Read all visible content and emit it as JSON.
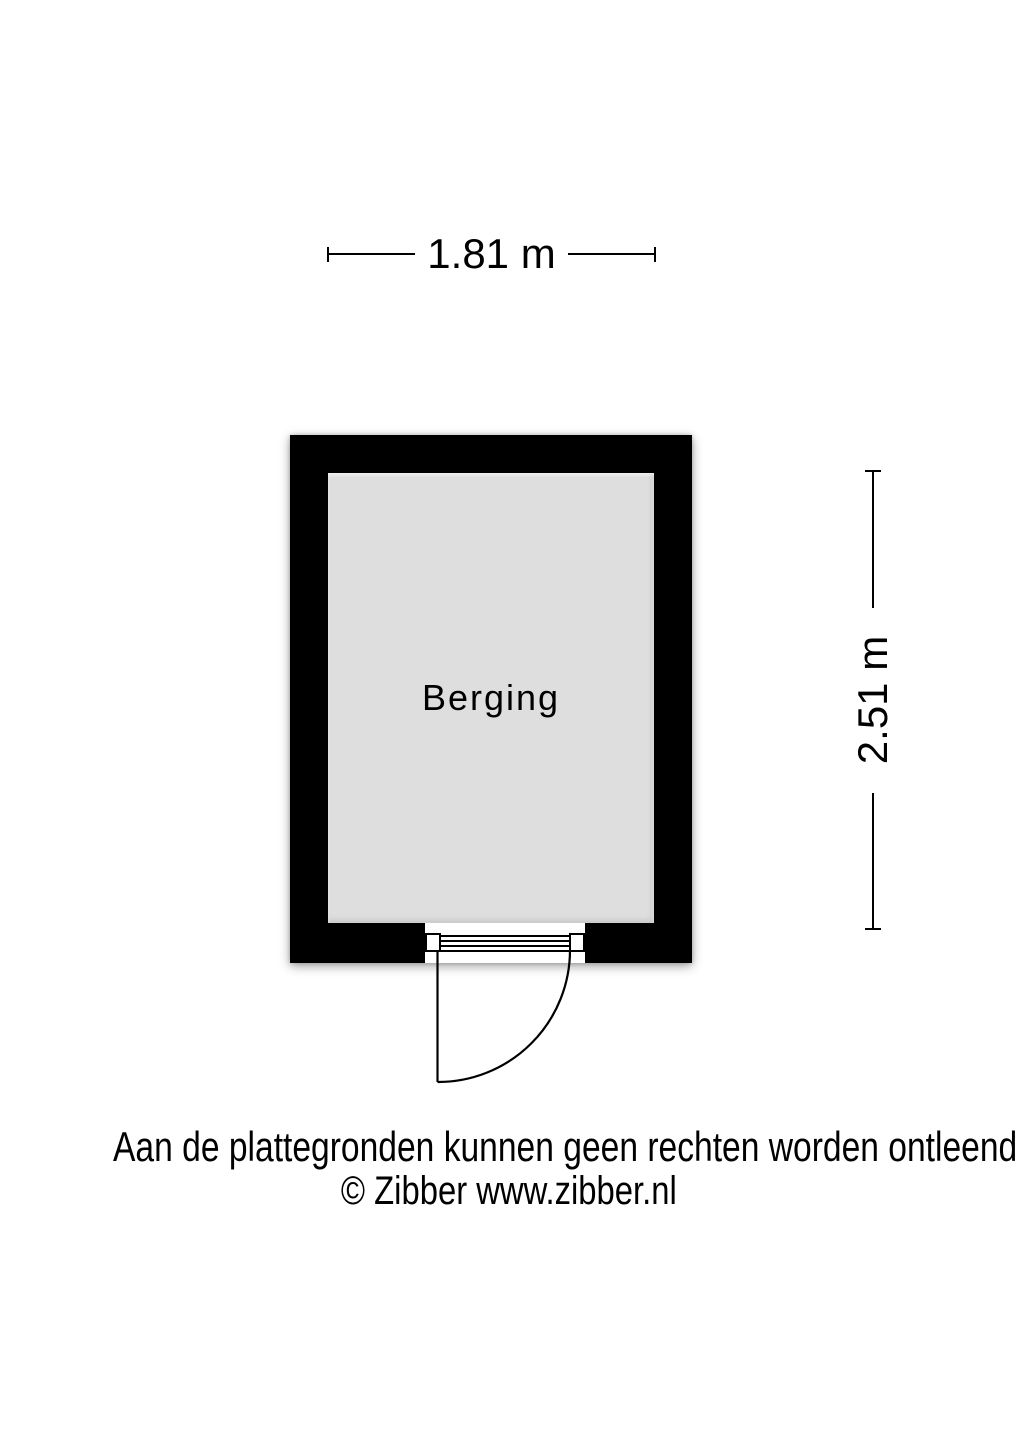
{
  "page": {
    "background_color": "#ffffff",
    "type": "floorplan"
  },
  "floorplan": {
    "room": {
      "label": "Berging",
      "wall_color": "#000000",
      "floor_color": "#dedede"
    },
    "dimensions": {
      "width": {
        "label": "1.81 m"
      },
      "height": {
        "label": "2.51 m"
      }
    },
    "door": {
      "type": "hinged-single-door",
      "position": "bottom-wall",
      "swing": "outward-left-hinge"
    },
    "line_color": "#000000"
  },
  "footer": {
    "disclaimer": "Aan de plattegronden kunnen geen rechten worden ontleend",
    "copyright": "© Zibber www.zibber.nl"
  }
}
